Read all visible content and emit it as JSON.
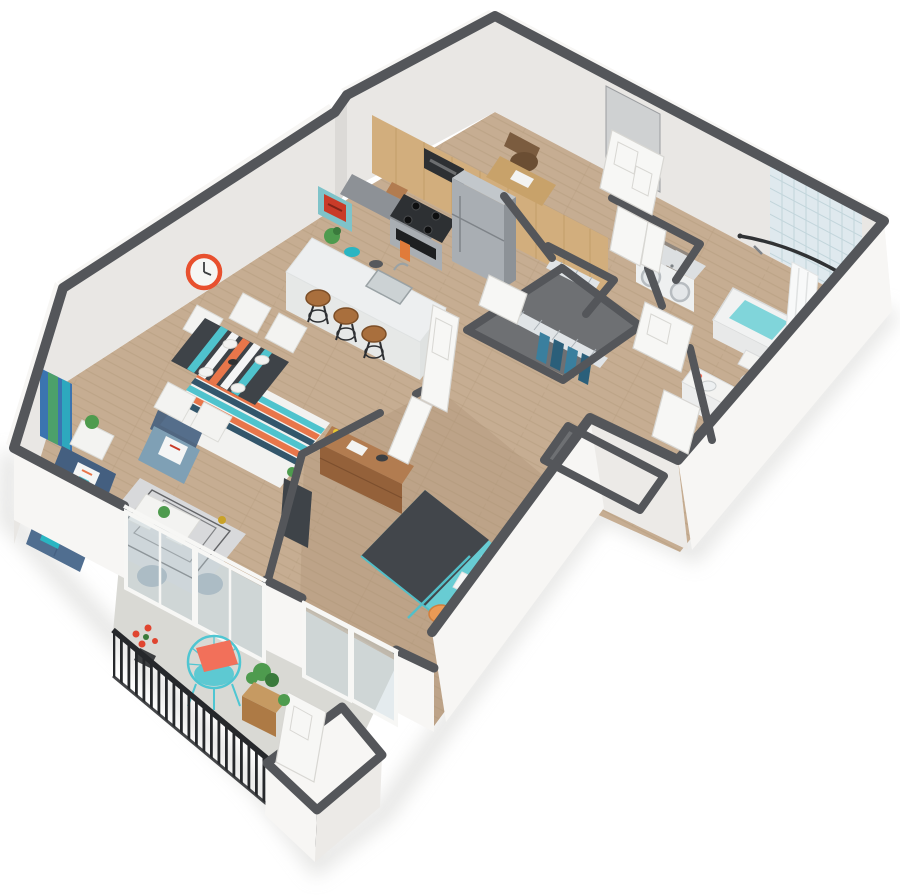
{
  "image": {
    "title": "One-Bedroom Apartment 3D Isometric Floor Plan Render",
    "type": "3d-floor-plan"
  },
  "colors": {
    "bg": "#ffffff",
    "shadow": "#cfcfcc",
    "wallCap": "#54565a",
    "wallInt": "#e9e7e4",
    "wallIntShade": "#dcdad7",
    "wallExt": "#f7f6f4",
    "wallExtShade": "#eceae7",
    "floorWood": "#c6ad92",
    "floorWoodDark": "#b49a7e",
    "plank": "#a8906f",
    "floorBalcony": "#d9d9d4",
    "floorCloset": "#6e7073",
    "rugBase": "#f2f2f0",
    "rugTeal": "#4fc3cd",
    "rugOrange": "#e8764a",
    "rugNavy": "#33566b",
    "rugLiving": "#d8d9db",
    "rugLine": "#46484b",
    "sofa": "#506e90",
    "sofaDark": "#445f80",
    "armchair": "#7fa0b5",
    "teal": "#2ab5c2",
    "pillow": "#f4f5f5",
    "pouf": "#9aa9b5",
    "tableDark": "#3e4348",
    "chairWhite": "#f3f3f1",
    "clockRed": "#e8502e",
    "clockFace": "#f6f6f4",
    "artTeal": "#7fc3c9",
    "artRed": "#c93b28",
    "artBlue": "#3b74b0",
    "artGreen": "#4ca06a",
    "cabinet": "#d2ae7d",
    "cabinetDark": "#b8905a",
    "counterDark": "#8d9196",
    "counterLight": "#edeff0",
    "islandFace": "#e6e8e7",
    "stainless": "#a9aeb3",
    "stainlessDark": "#8d9297",
    "steelTrim": "#7e8388",
    "rangeBlack": "#2d3033",
    "stoolWood": "#a96f3d",
    "stoolLeg": "#2e3033",
    "desk": "#c8a26a",
    "chairBrown": "#7b5c3f",
    "door": "#f7f7f5",
    "doorShade": "#d8d7d3",
    "glass": "#c3d3da",
    "appliance": "#eef0f0",
    "applianceShade": "#dcdfe1",
    "applianceTrim": "#b7bcc0",
    "wireBand": "#e0e4e7",
    "wireLine": "#a9b0b6",
    "clothesA": "#3a7f9e",
    "clothesB": "#2b5f7a",
    "tub": "#f1f2f2",
    "tubFace": "#e8e9e9",
    "water": "#80d5da",
    "tile": "#dfe9ee",
    "tileLine": "#c2d5db",
    "curtain": "#f8f9f9",
    "rod": "#303234",
    "porcelain": "#f6f7f7",
    "porcelainShade": "#eceded",
    "bedTeal": "#68ccd3",
    "bedTealDark": "#53bfc8",
    "blanket": "#42464b",
    "blanketLine": "#34383c",
    "dresser": "#b27c50",
    "dresserDark": "#94613a",
    "stoolOrange": "#eb9a55",
    "stoolOrangeDark": "#d07f3e",
    "rail": "#26282b",
    "chairWire": "#4fc6d2",
    "coral": "#f2705a",
    "planter": "#c69a62",
    "planterDark": "#ad7a45",
    "green": "#4e9b4e",
    "greenDark": "#3a7a3c",
    "flower": "#e0452f",
    "gold": "#c9a227"
  },
  "scene": {
    "view": "isometric-3d-render",
    "rooms": [
      {
        "name": "Living Room",
        "items": [
          "sofa",
          "accent-armchair",
          "coffee-table",
          "area-rug",
          "side-table",
          "poufs",
          "media-console",
          "wall-art",
          "sliding-glass-doors"
        ]
      },
      {
        "name": "Dining Area",
        "items": [
          "dining-table",
          "dining-chairs",
          "striped-rug",
          "table-runner",
          "wall-clock",
          "framed-art"
        ]
      },
      {
        "name": "Kitchen",
        "items": [
          "wood-cabinets",
          "microwave",
          "range-oven",
          "refrigerator",
          "island-with-sink",
          "bar-stools",
          "decor-bowls"
        ]
      },
      {
        "name": "Entry Nook",
        "items": [
          "entry-door",
          "desk",
          "office-chair"
        ]
      },
      {
        "name": "Hallway",
        "items": [
          "walk-in-closet",
          "linen-closet",
          "wire-shelving",
          "hanging-clothes",
          "doors"
        ]
      },
      {
        "name": "Laundry Closet",
        "items": [
          "washer",
          "dryer",
          "bifold-doors"
        ]
      },
      {
        "name": "Bathroom",
        "items": [
          "bathtub",
          "tile-surround",
          "curved-shower-rod",
          "shower-curtain",
          "toilet",
          "vanity-sink",
          "door"
        ]
      },
      {
        "name": "Bedroom",
        "items": [
          "teal-bed",
          "charcoal-throw",
          "pillows",
          "dresser",
          "round-side-stools",
          "bedroom-closet",
          "sliding-glass-doors"
        ]
      },
      {
        "name": "Balcony",
        "items": [
          "metal-railing",
          "wire-lounge-chair",
          "coral-pillow",
          "planter-box",
          "potted-flowers",
          "storage-closet"
        ]
      }
    ],
    "counts": {
      "bar_stools": 3,
      "dining_chairs": 5,
      "sliding_door_panels": 4,
      "poufs": 2,
      "closet_shelves": 4
    }
  }
}
